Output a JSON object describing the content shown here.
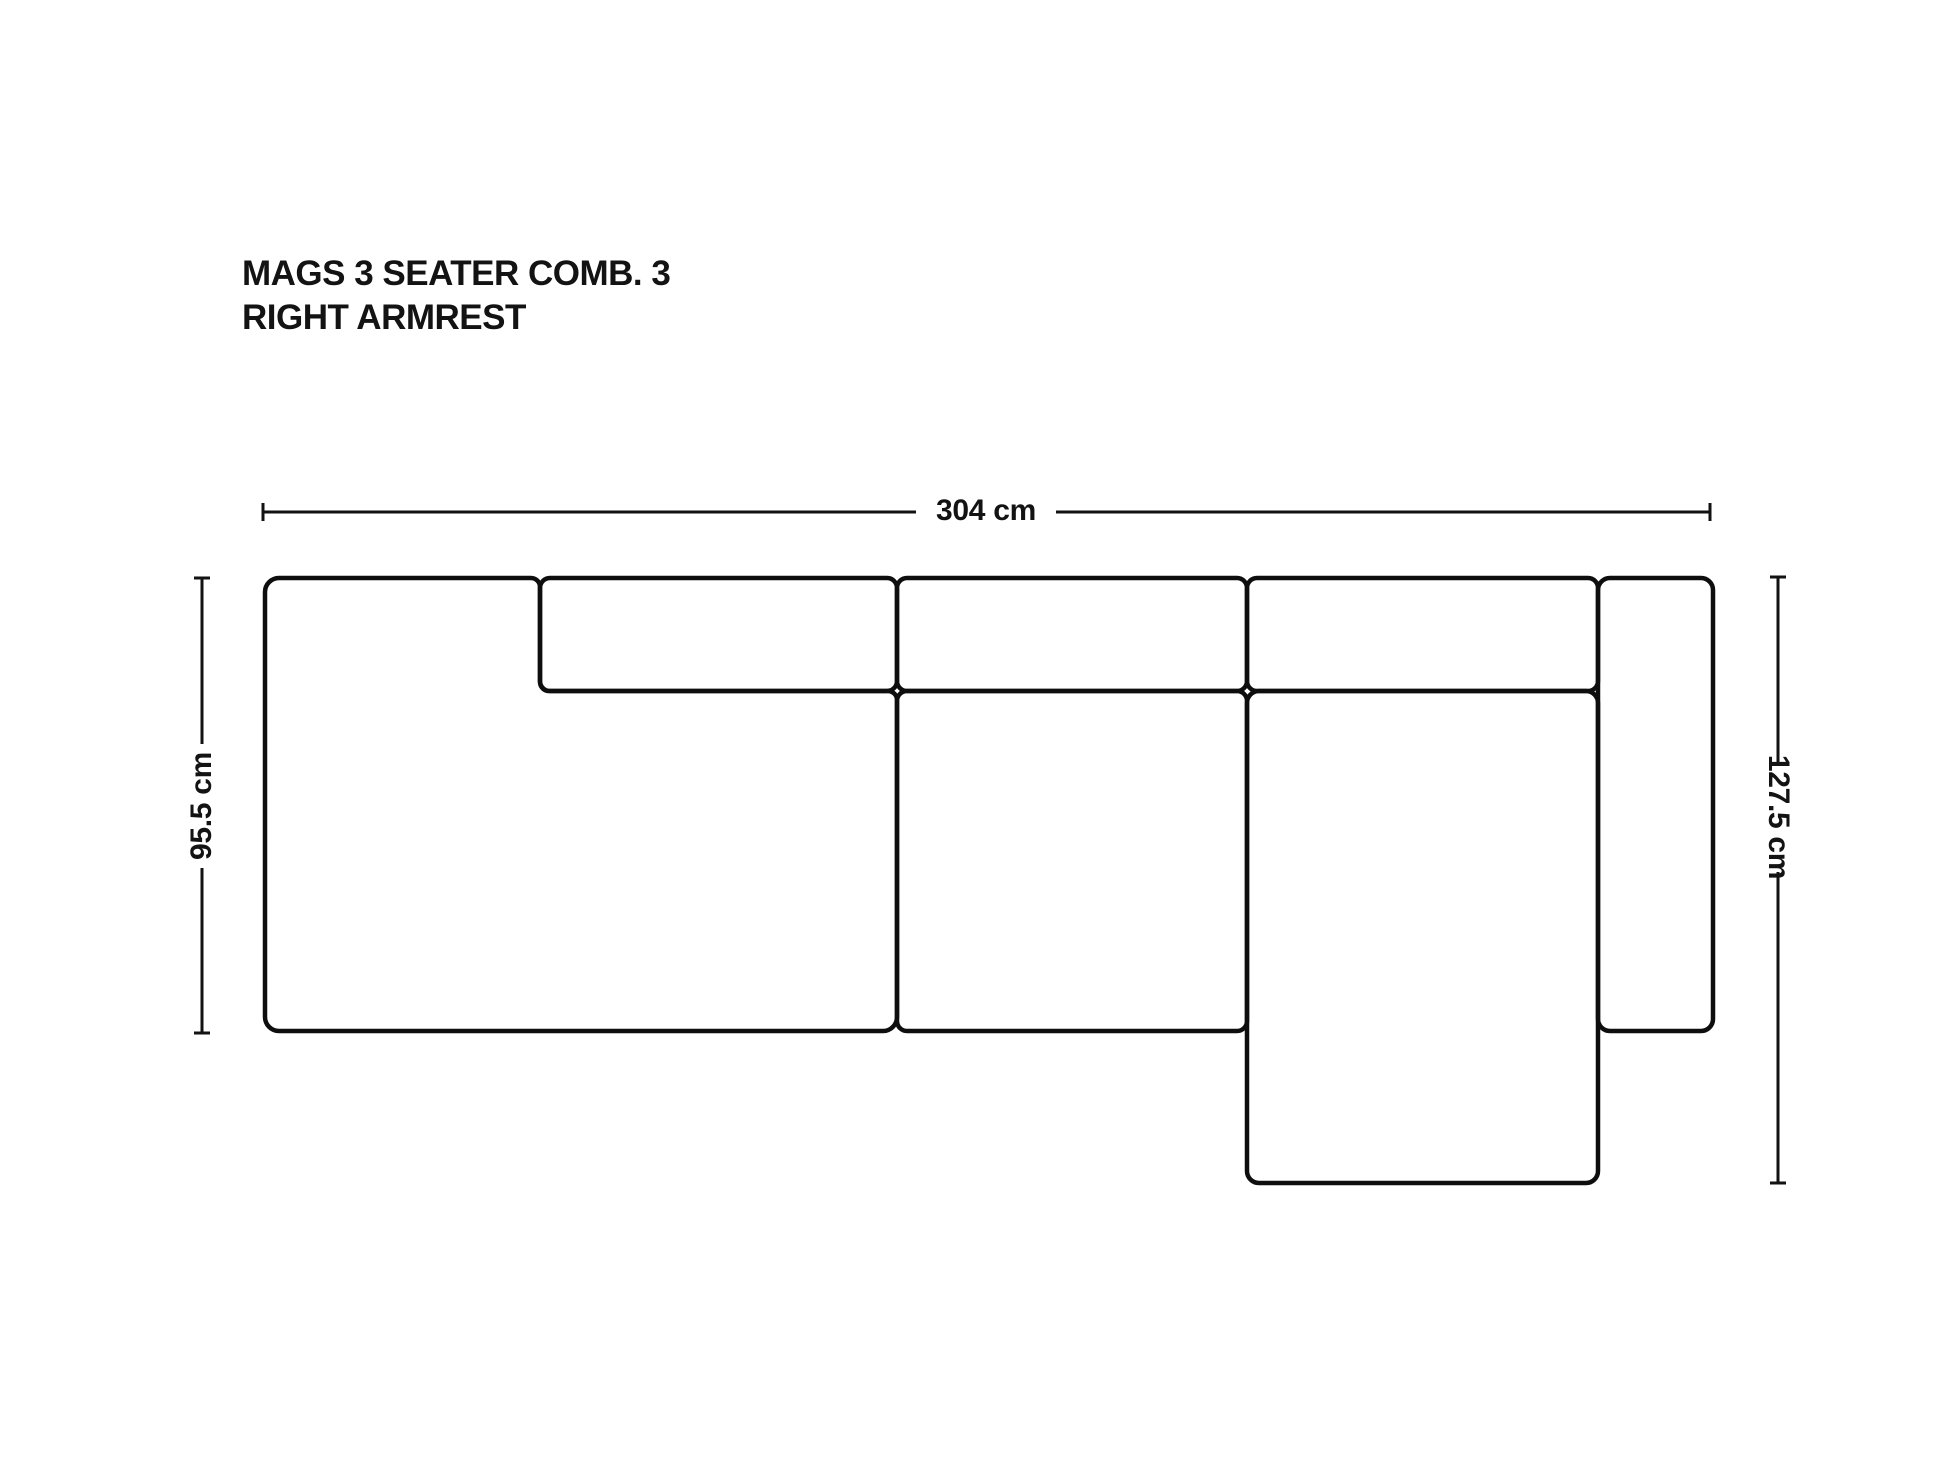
{
  "title": {
    "line1": "MAGS 3 SEATER COMB. 3",
    "line2": "RIGHT ARMREST"
  },
  "dimensions": {
    "width": "304 cm",
    "depth_left": "95.5 cm",
    "depth_right": "127.5 cm"
  },
  "parts": {
    "left_module": "left seat module with left armrest",
    "left_cushion": "left backrest cushion",
    "middle_cushion": "middle backrest cushion",
    "right_cushion": "right backrest cushion",
    "middle_seat": "middle seat module",
    "chaise": "chaise longue / short chaise seat",
    "right_armrest": "right armrest"
  },
  "colors": {
    "background": "#ffffff",
    "outline": "#0e0e0e",
    "text": "#131313"
  }
}
